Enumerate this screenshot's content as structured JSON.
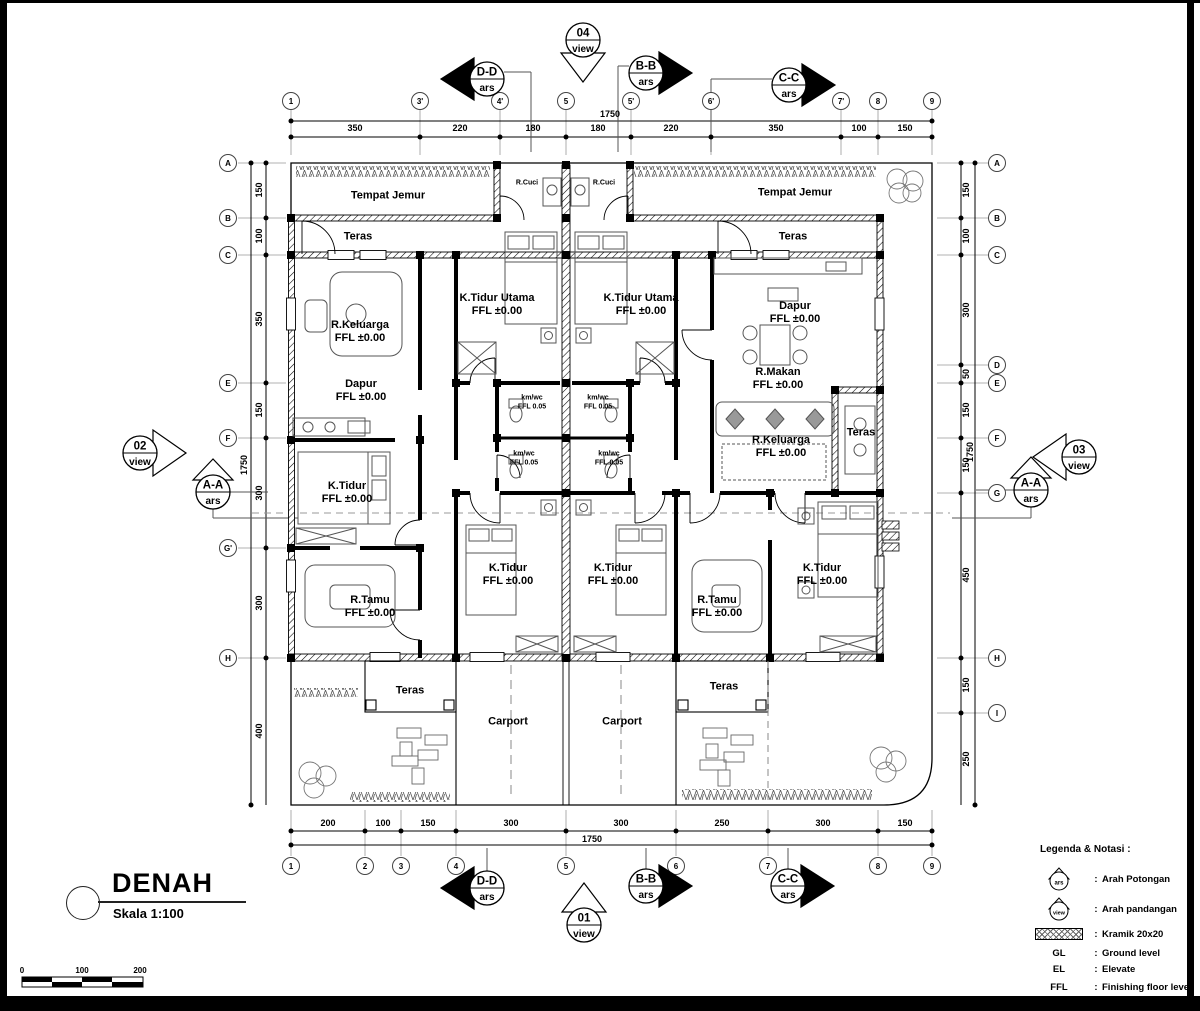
{
  "title": {
    "name": "DENAH",
    "scale": "Skala 1:100"
  },
  "scale_bar": {
    "ticks": [
      "0",
      "100",
      "200"
    ]
  },
  "legend": {
    "heading": "Legenda & Notasi :",
    "items": [
      {
        "type": "ars",
        "symbol_text": "ars",
        "sep": ":",
        "label": "Arah Potongan"
      },
      {
        "type": "view",
        "symbol_text": "view",
        "sep": ":",
        "label": "Arah pandangan"
      },
      {
        "type": "hatch",
        "sep": ":",
        "label": "Kramik 20x20"
      },
      {
        "type": "abbr",
        "abbr": "GL",
        "sep": ":",
        "label": "Ground level"
      },
      {
        "type": "abbr",
        "abbr": "EL",
        "sep": ":",
        "label": "Elevate"
      },
      {
        "type": "abbr",
        "abbr": "FFL",
        "sep": ":",
        "label": "Finishing floor level"
      }
    ]
  },
  "grid": {
    "top": {
      "cols": [
        {
          "label": "1",
          "x": 291
        },
        {
          "label": "3'",
          "x": 420
        },
        {
          "label": "4'",
          "x": 500
        },
        {
          "label": "5",
          "x": 566
        },
        {
          "label": "5'",
          "x": 631
        },
        {
          "label": "6'",
          "x": 711
        },
        {
          "label": "7'",
          "x": 841
        },
        {
          "label": "8",
          "x": 878
        },
        {
          "label": "9",
          "x": 932
        }
      ],
      "dims": [
        {
          "text": "350",
          "x": 355
        },
        {
          "text": "220",
          "x": 460
        },
        {
          "text": "180",
          "x": 533
        },
        {
          "text": "180",
          "x": 598
        },
        {
          "text": "220",
          "x": 671
        },
        {
          "text": "350",
          "x": 776
        },
        {
          "text": "100",
          "x": 859
        },
        {
          "text": "150",
          "x": 905
        }
      ],
      "total": "1750",
      "total_x": 610,
      "total_y": 114
    },
    "bottom": {
      "cols": [
        {
          "label": "1",
          "x": 291
        },
        {
          "label": "2",
          "x": 365
        },
        {
          "label": "3",
          "x": 401
        },
        {
          "label": "4",
          "x": 456
        },
        {
          "label": "5",
          "x": 566
        },
        {
          "label": "6",
          "x": 676
        },
        {
          "label": "7",
          "x": 768
        },
        {
          "label": "8",
          "x": 878
        },
        {
          "label": "9",
          "x": 932
        }
      ],
      "dims": [
        {
          "text": "200",
          "x": 328
        },
        {
          "text": "100",
          "x": 383
        },
        {
          "text": "150",
          "x": 428
        },
        {
          "text": "300",
          "x": 511
        },
        {
          "text": "300",
          "x": 621
        },
        {
          "text": "250",
          "x": 722
        },
        {
          "text": "300",
          "x": 823
        },
        {
          "text": "150",
          "x": 905
        }
      ],
      "total": "1750",
      "total_x": 592,
      "total_y": 839
    },
    "left": {
      "rows": [
        {
          "label": "A",
          "y": 163
        },
        {
          "label": "B",
          "y": 218
        },
        {
          "label": "C",
          "y": 255
        },
        {
          "label": "E",
          "y": 383
        },
        {
          "label": "F",
          "y": 438
        },
        {
          "label": "G'",
          "y": 548
        },
        {
          "label": "H",
          "y": 658
        }
      ],
      "dims": [
        {
          "text": "150",
          "y": 190
        },
        {
          "text": "100",
          "y": 236
        },
        {
          "text": "350",
          "y": 319
        },
        {
          "text": "150",
          "y": 410
        },
        {
          "text": "300",
          "y": 493
        },
        {
          "text": "300",
          "y": 603
        },
        {
          "text": "400",
          "y": 731
        }
      ],
      "total": "1750",
      "total_x": 244,
      "total_y": 465
    },
    "right": {
      "rows": [
        {
          "label": "A",
          "y": 163
        },
        {
          "label": "B",
          "y": 218
        },
        {
          "label": "C",
          "y": 255
        },
        {
          "label": "D",
          "y": 365
        },
        {
          "label": "E",
          "y": 383
        },
        {
          "label": "F",
          "y": 438
        },
        {
          "label": "G",
          "y": 493
        },
        {
          "label": "H",
          "y": 658
        },
        {
          "label": "I",
          "y": 713
        }
      ],
      "dims": [
        {
          "text": "150",
          "y": 190
        },
        {
          "text": "100",
          "y": 236
        },
        {
          "text": "300",
          "y": 310
        },
        {
          "text": "50",
          "y": 374
        },
        {
          "text": "150",
          "y": 410
        },
        {
          "text": "150",
          "y": 465
        },
        {
          "text": "450",
          "y": 575
        },
        {
          "text": "150",
          "y": 685
        },
        {
          "text": "250",
          "y": 759
        }
      ],
      "total": "1750",
      "total_x": 970,
      "total_y": 452
    }
  },
  "rooms": [
    {
      "name": "Tempat Jemur",
      "x": 388,
      "y": 196
    },
    {
      "name": "Tempat Jemur",
      "x": 795,
      "y": 193
    },
    {
      "name": "R.Cuci",
      "x": 527,
      "y": 184,
      "small": true
    },
    {
      "name": "R.Cuci",
      "x": 604,
      "y": 184,
      "small": true
    },
    {
      "name": "Teras",
      "x": 358,
      "y": 237
    },
    {
      "name": "Teras",
      "x": 793,
      "y": 237
    },
    {
      "name": "K.Tidur Utama",
      "ffl": "FFL ±0.00",
      "x": 497,
      "y": 305
    },
    {
      "name": "K.Tidur Utama",
      "ffl": "FFL ±0.00",
      "x": 641,
      "y": 305
    },
    {
      "name": "R.Keluarga",
      "ffl": "FFL ±0.00",
      "x": 360,
      "y": 332
    },
    {
      "name": "Dapur",
      "ffl": "FFL ±0.00",
      "x": 795,
      "y": 313
    },
    {
      "name": "Dapur",
      "ffl": "FFL ±0.00",
      "x": 361,
      "y": 391
    },
    {
      "name": "R.Makan",
      "ffl": "FFL ±0.00",
      "x": 778,
      "y": 379
    },
    {
      "name": "km/wc",
      "ffl": "FFL 0.05",
      "x": 532,
      "y": 403,
      "small": true
    },
    {
      "name": "km/wc",
      "ffl": "FFL 0.05",
      "x": 598,
      "y": 403,
      "small": true
    },
    {
      "name": "R.Keluarga",
      "ffl": "FFL ±0.00",
      "x": 781,
      "y": 447
    },
    {
      "name": "Teras",
      "x": 861,
      "y": 433
    },
    {
      "name": "km/wc",
      "ffl": "FFL 0.05",
      "x": 524,
      "y": 459,
      "small": true
    },
    {
      "name": "km/wc",
      "ffl": "FFL 0.05",
      "x": 609,
      "y": 459,
      "small": true
    },
    {
      "name": "K.Tidur",
      "ffl": "FFL ±0.00",
      "x": 347,
      "y": 493
    },
    {
      "name": "K.Tidur",
      "ffl": "FFL ±0.00",
      "x": 508,
      "y": 575
    },
    {
      "name": "K.Tidur",
      "ffl": "FFL ±0.00",
      "x": 613,
      "y": 575
    },
    {
      "name": "K.Tidur",
      "ffl": "FFL ±0.00",
      "x": 822,
      "y": 575
    },
    {
      "name": "R.Tamu",
      "ffl": "FFL ±0.00",
      "x": 370,
      "y": 607
    },
    {
      "name": "R.Tamu",
      "ffl": "FFL ±0.00",
      "x": 717,
      "y": 607
    },
    {
      "name": "Teras",
      "x": 410,
      "y": 691
    },
    {
      "name": "Teras",
      "x": 724,
      "y": 687
    },
    {
      "name": "Carport",
      "x": 508,
      "y": 722
    },
    {
      "name": "Carport",
      "x": 622,
      "y": 722
    }
  ],
  "markers": [
    {
      "kind": "view",
      "id": "04",
      "sub": "view",
      "x": 583,
      "y": 40,
      "dir": "down"
    },
    {
      "kind": "view",
      "id": "01",
      "sub": "view",
      "x": 584,
      "y": 925,
      "dir": "up"
    },
    {
      "kind": "view",
      "id": "02",
      "sub": "view",
      "x": 140,
      "y": 453,
      "dir": "right"
    },
    {
      "kind": "view",
      "id": "03",
      "sub": "view",
      "x": 1079,
      "y": 457,
      "dir": "left"
    },
    {
      "kind": "ars",
      "id": "D-D",
      "sub": "ars",
      "x": 487,
      "y": 79,
      "dir": "left"
    },
    {
      "kind": "ars",
      "id": "B-B",
      "sub": "ars",
      "x": 646,
      "y": 73,
      "dir": "right"
    },
    {
      "kind": "ars",
      "id": "C-C",
      "sub": "ars",
      "x": 789,
      "y": 85,
      "dir": "right"
    },
    {
      "kind": "ars",
      "id": "A-A",
      "sub": "ars",
      "x": 213,
      "y": 492,
      "dir": "hat"
    },
    {
      "kind": "ars",
      "id": "A-A",
      "sub": "ars",
      "x": 1031,
      "y": 490,
      "dir": "hat"
    },
    {
      "kind": "ars",
      "id": "D-D",
      "sub": "ars",
      "x": 487,
      "y": 888,
      "dir": "left"
    },
    {
      "kind": "ars",
      "id": "B-B",
      "sub": "ars",
      "x": 646,
      "y": 886,
      "dir": "right"
    },
    {
      "kind": "ars",
      "id": "C-C",
      "sub": "ars",
      "x": 788,
      "y": 886,
      "dir": "right"
    }
  ]
}
